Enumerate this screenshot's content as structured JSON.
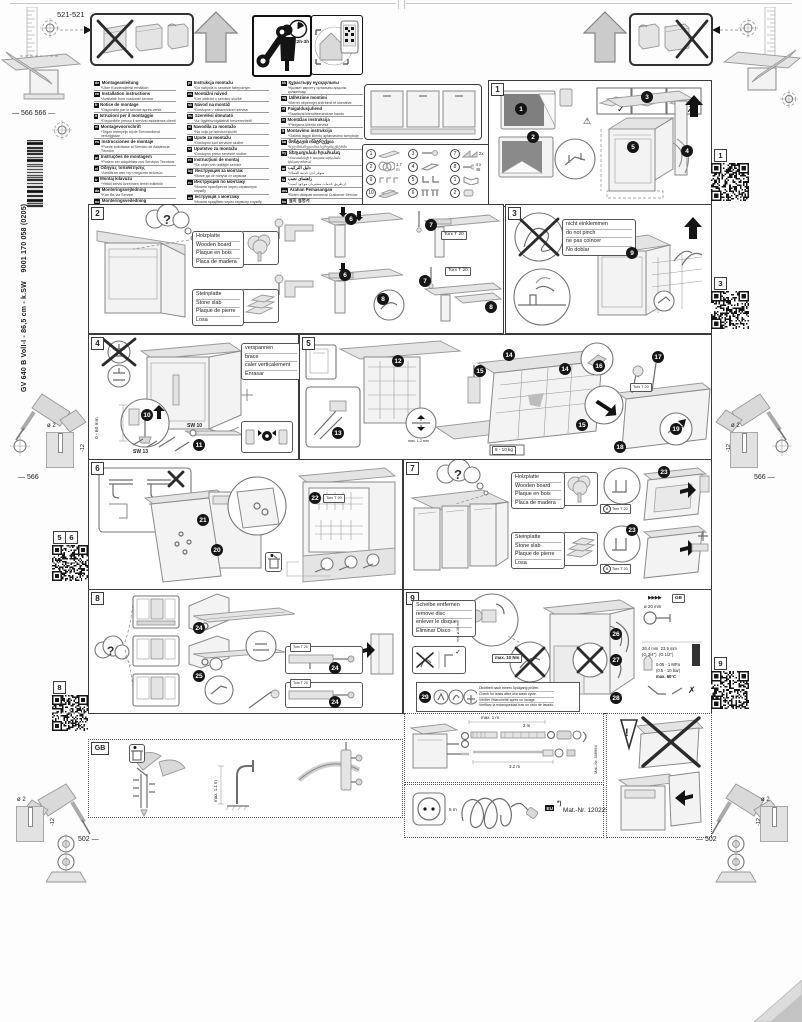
{
  "doc": {
    "order_number": "9001 170 058 (0205)",
    "model": "GV 640 B VolI-I - 86,5 cm - k.SW",
    "install_time": "<2h-3h"
  },
  "icons": {
    "check": "✓",
    "cross": "✗",
    "warning": "⚠",
    "question": "?",
    "arrows": "▶▶▶▶"
  },
  "dims": {
    "top_left": "521-521",
    "left_mid": "566 566",
    "drill_dia": "ø 2",
    "drill_depth": "-12",
    "side_hole": "566",
    "hinge_hole": "502"
  },
  "materials": {
    "wooden": [
      "Holzplatte",
      "Wooden board",
      "Plaque en bois",
      "Placa de madera"
    ],
    "stone": [
      "Steinplatte",
      "Stone slab",
      "Plaque de pierre",
      "Losa"
    ]
  },
  "tools": {
    "torx": "Torx T 20",
    "sw13": "SW 13",
    "sw10": "SW 10"
  },
  "qr_tabs": {
    "q1": "1",
    "q3": "3",
    "q5": "5",
    "q6": "6",
    "q8": "8",
    "q9": "9"
  },
  "languages": {
    "col1": [
      {
        "code": "de",
        "title": "Montageanleitung",
        "note": "*Über Kundendienst erhältlich"
      },
      {
        "code": "en",
        "title": "Installation instructions",
        "note": "*Available from customer service"
      },
      {
        "code": "fr",
        "title": "Notice de montage",
        "note": "*Disponible par le service après-vente"
      },
      {
        "code": "it",
        "title": "Istruzioni per il montaggio",
        "note": "*Disponibile presso il servizio assistenza clienti"
      },
      {
        "code": "nl",
        "title": "Montagevoorschrift",
        "note": "*Tegen meerprijs bij de Servicedienst verkrijgbaar"
      },
      {
        "code": "es",
        "title": "Instrucciones de montaje",
        "note": "*Puede solicitarse al Servicio de Asistencia Técnica"
      },
      {
        "code": "pt",
        "title": "Instruções de montagem",
        "note": "*Podem ser adquiridas nos Serviços Técnicos"
      },
      {
        "code": "el",
        "title": "Οδηγίες τοποθέτησης",
        "note": "*Διατίθεται από την υπηρεσία πελατών"
      },
      {
        "code": "tr",
        "title": "Montaj kılavuzu",
        "note": "*Yetkili servis üzerinden temin edilebilir"
      },
      {
        "code": "da",
        "title": "Monteringsvejledning",
        "note": "*Kan fås via Service"
      },
      {
        "code": "no",
        "title": "Monteringsveiledning",
        "note": "*Fåes hos kundeservice"
      },
      {
        "code": "sv",
        "title": "Monteringsanvisning",
        "note": "*Kan köpas hos serviceavdelningen"
      },
      {
        "code": "fi",
        "title": "Asennusohje",
        "note": "*Saatavana huoltopalvelusta"
      }
    ],
    "col2": [
      {
        "code": "pl",
        "title": "Instrukcja montażu",
        "note": "*Do nabycia w serwisie fabrycznym"
      },
      {
        "code": "cs",
        "title": "Montážní návod",
        "note": "*Lze obdržet v servisní službě"
      },
      {
        "code": "sk",
        "title": "Návod na montáž",
        "note": "*Dostupné v zákazníckom servise"
      },
      {
        "code": "hu",
        "title": "Szerelési útmutató",
        "note": "*Az ügyfélszolgálatnál beszerezhető"
      },
      {
        "code": "sl",
        "title": "Navodila za montažo",
        "note": "*Na voljo pri servisni službi"
      },
      {
        "code": "hr",
        "title": "Upute za montažu",
        "note": "*Dostupno kod servisne službe"
      },
      {
        "code": "sr",
        "title": "Uputstvo za montažu",
        "note": "*Dostupno preko servisne službe"
      },
      {
        "code": "ro",
        "title": "Instrucţiuni de montaj",
        "note": "*Se obţin prin unităţile service"
      },
      {
        "code": "bg",
        "title": "Инструкция за монтаж",
        "note": "*Може да се получи от сервиза"
      },
      {
        "code": "ru",
        "title": "Инструкция по монтажу",
        "note": "*Можно приобрести через сервисную службу"
      },
      {
        "code": "uk",
        "title": "Інструкція з монтажу",
        "note": "*Можна придбати через сервісну службу"
      },
      {
        "code": "mk",
        "title": "Упатство за монтажа",
        "note": "*Достапно преку сервисната служба"
      }
    ],
    "col3": [
      {
        "code": "kk",
        "title": "Құрастыру нұсқаулығы",
        "note": "*Қызмет көрсету орталығы арқылы қолжетімді"
      },
      {
        "code": "sq",
        "title": "Udhëzime montimi",
        "note": "*Merret nëpërmjet shërbimit të klientëve"
      },
      {
        "code": "et",
        "title": "Paigaldusjuhend",
        "note": "*Saadaval klienditeeninduse kaudu"
      },
      {
        "code": "lv",
        "title": "Montāžas instrukcija",
        "note": "*Pieejama klientu servisā"
      },
      {
        "code": "lt",
        "title": "Montavimo instrukcija",
        "note": "*Galima įsigyti klientų aptarnavimo tarnyboje"
      },
      {
        "code": "ka",
        "title": "მონტაჟის ინსტრუქცია",
        "note": "*ხელმისაწვდომია სერვისცენტრში"
      },
      {
        "code": "hy",
        "title": "Տեղադրման հրահանգ",
        "note": "*Հասանելի է սպասարկման կենտրոնում"
      },
      {
        "code": "ar",
        "title": "دليل التركيب",
        "note": "*متوفر لدى خدمة العملاء"
      },
      {
        "code": "fa",
        "title": "راهنمای نصب",
        "note": "*از طریق خدمات مشتریان موجود است"
      },
      {
        "code": "ms",
        "title": "Arahan Pemasangan",
        "note": "*Boleh didapati menerusi Customer Service"
      },
      {
        "code": "ko",
        "title": "설치 설명서",
        "note": "*서비스센터에서 구입 가능"
      },
      {
        "code": "zh",
        "title": "安装说明",
        "note": "*可向售后服务部门购买"
      }
    ]
  },
  "parts": [
    {
      "n": "1",
      "note": ""
    },
    {
      "n": "2",
      "note": "1.7 m"
    },
    {
      "n": "3",
      "note": ""
    },
    {
      "n": "4",
      "note": ""
    },
    {
      "n": "5",
      "note": ""
    },
    {
      "n": "6",
      "note": ""
    },
    {
      "n": "7",
      "note": "2x"
    },
    {
      "n": "8",
      "note": "4 x 45"
    },
    {
      "n": "9",
      "note": ""
    },
    {
      "n": "10",
      "note": ""
    }
  ],
  "panels": {
    "p1": {
      "num": "1",
      "steps": [
        "1",
        "2",
        "3",
        "4",
        "5"
      ]
    },
    "p2": {
      "num": "2",
      "steps": [
        "6",
        "7",
        "8"
      ]
    },
    "p3": {
      "num": "3",
      "step": "9",
      "note": [
        "nicht einklemmen",
        "do not pinch",
        "ne pas coincer",
        "No doblar"
      ]
    },
    "p4": {
      "num": "4",
      "steps": [
        "10",
        "11"
      ],
      "note": [
        "verspannen",
        "brace",
        "caler verticalement",
        "Enrasar"
      ],
      "range": "0 - 60 mm"
    },
    "p5": {
      "num": "5",
      "steps": [
        "12",
        "13",
        "14",
        "15",
        "16",
        "17",
        "18",
        "19"
      ],
      "gap": "max. 1.2 mm",
      "weight": "5 - 10 kg"
    },
    "p6": {
      "num": "6",
      "steps": [
        "20",
        "21",
        "22"
      ]
    },
    "p7": {
      "num": "7",
      "step": "23"
    },
    "p8": {
      "num": "8",
      "steps": [
        "24",
        "25"
      ]
    },
    "p9": {
      "num": "9",
      "steps": [
        "26",
        "27",
        "28"
      ],
      "leak_step": "29",
      "note": [
        "Scheibe entfernen",
        "remove disc",
        "enlever le disque",
        "Eliminar Disco"
      ],
      "torque": "max. 10 Nm",
      "min_dia": "min. ø 16 mm",
      "leak": [
        "Dichtheit nach einem Spülgang prüfen.",
        "Check for leaks after one wash cycle.",
        "Vérifier l'étanchéité après un lavage.",
        "Verificar la estanqueidad tras un ciclo de lavado."
      ],
      "specs": {
        "gb": "GB",
        "dia": "ø 20 mm",
        "t1": "26.4 mm",
        "t2": "23.9 mm",
        "g1": "(G 3/4\")",
        "g2": "(G 1/2\")",
        "press1": "0.05 - 1 MPa",
        "press2": "(0.5 - 10 bar)",
        "temp": "max. 60°C"
      }
    },
    "gb": {
      "label": "GB",
      "standpipe": "max. 1.1 m"
    },
    "hoses": {
      "h1": "max. 1 m",
      "h2": "2 m",
      "h3": "3.2 m",
      "mat": "Mat.-Nr. 346964"
    },
    "power": {
      "len": "5 m",
      "region": "EU",
      "star": "*)",
      "mat": "Mat.-Nr. 12022522"
    }
  }
}
